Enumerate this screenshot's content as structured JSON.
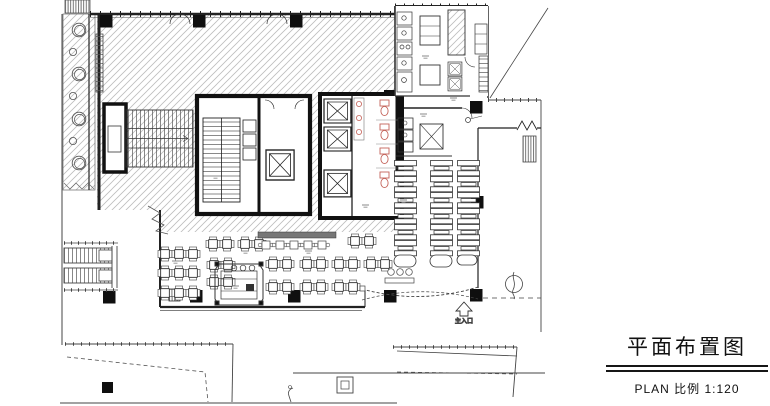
{
  "title_block": {
    "title": "平面布置图",
    "scale_label": "PLAN 比例 1:120"
  },
  "plan": {
    "entrance_label": "主入口",
    "colors": {
      "paper": "#ffffff",
      "line": "#222222",
      "hatch_line": "#bdbdbd",
      "column_fill": "#0f0f0f",
      "fixture_accent": "#c4635a",
      "cyan_mark": "#45c8d2"
    },
    "icons": {
      "elevator-shaft-icon": "rectangle with X",
      "column-icon": "solid black square",
      "tree-icon": "concentric circles",
      "stair-icon": "parallel tread lines",
      "escalator-icon": "striped parallel bands",
      "entrance-arrow-icon": "hollow up arrow",
      "door-swing-icon": "quarter-circle arc"
    }
  }
}
